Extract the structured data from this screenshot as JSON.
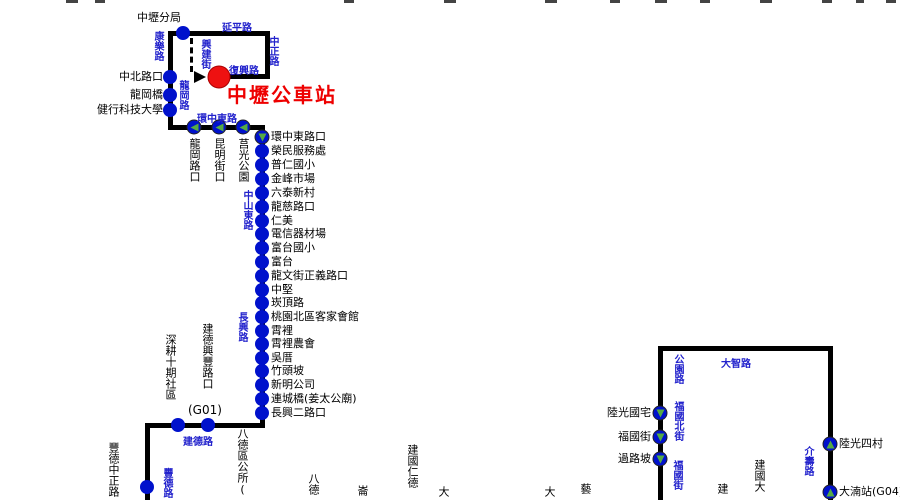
{
  "terminal": {
    "label": "中壢公車站"
  },
  "colors": {
    "line": "#000000",
    "stop_dot": "#0011cc",
    "road_text": "#2222cc",
    "terminal_red": "#ee1111",
    "direction_arrow_green": "#55aa44"
  },
  "roads": {
    "yanping": "延平路",
    "zhongzheng": "中正路",
    "kangle": "康樂路",
    "xingjian": "興建街",
    "fuxing": "復興路",
    "longgang": "龍岡路",
    "huanzhongdong": "環中東路",
    "zhongshandong": "中山東路",
    "changxing": "長興路",
    "jiande": "建德路",
    "fengde": "豐德路",
    "gongyuan": "公園路",
    "fuguobei": "福國北街",
    "fuguo": "福國街",
    "dazhi": "大智路",
    "jieshou": "介壽路"
  },
  "top_stops": [
    {
      "label": "中壢分局"
    },
    {
      "label": "中北路口"
    },
    {
      "label": "龍岡橋"
    },
    {
      "label": "健行科技大學"
    }
  ],
  "huanzhong_stops": [
    {
      "label": "龍岡路口",
      "arrow": "left"
    },
    {
      "label": "昆明街口",
      "arrow": "left"
    },
    {
      "label": "莒光公園",
      "arrow": "left"
    }
  ],
  "main_stops": [
    {
      "label": "環中東路口",
      "arrow": "down"
    },
    {
      "label": "榮民服務處"
    },
    {
      "label": "普仁國小"
    },
    {
      "label": "金峰市場"
    },
    {
      "label": "六泰新村"
    },
    {
      "label": "龍慈路口"
    },
    {
      "label": "仁美"
    },
    {
      "label": "電信器材場"
    },
    {
      "label": "富台國小"
    },
    {
      "label": "富台"
    },
    {
      "label": "龍文街正義路口"
    },
    {
      "label": "中堅"
    },
    {
      "label": "崁頂路"
    },
    {
      "label": "桃園北區客家會館"
    },
    {
      "label": "霄裡"
    },
    {
      "label": "霄裡農會"
    },
    {
      "label": "吳厝"
    },
    {
      "label": "竹頭坡"
    },
    {
      "label": "新明公司"
    },
    {
      "label": "連城橋(姜太公廟)"
    },
    {
      "label": "長興二路口"
    }
  ],
  "jiande_stops": [
    {
      "label": "深耕十期社區"
    },
    {
      "label": "建德興豐路口",
      "code": "(G01)"
    }
  ],
  "fengde_stops": [
    {
      "label": "豐德中正路"
    }
  ],
  "bottom_cut_labels": [
    {
      "label": "八德區公所("
    },
    {
      "label": "八德"
    },
    {
      "label": "崙"
    },
    {
      "label": "建國仁德"
    },
    {
      "label": "大"
    },
    {
      "label": "大"
    },
    {
      "label": "藝"
    },
    {
      "label": "建"
    },
    {
      "label": "建國大"
    }
  ],
  "right_loop": {
    "left_stops": [
      {
        "label": "陸光國宅",
        "arrow": "down"
      },
      {
        "label": "福國街",
        "arrow": "down"
      },
      {
        "label": "過路坡",
        "arrow": "down"
      }
    ],
    "right_stops": [
      {
        "label": "陸光四村",
        "arrow": "up"
      },
      {
        "label": "大湳站(G04)",
        "arrow": "up"
      }
    ]
  }
}
